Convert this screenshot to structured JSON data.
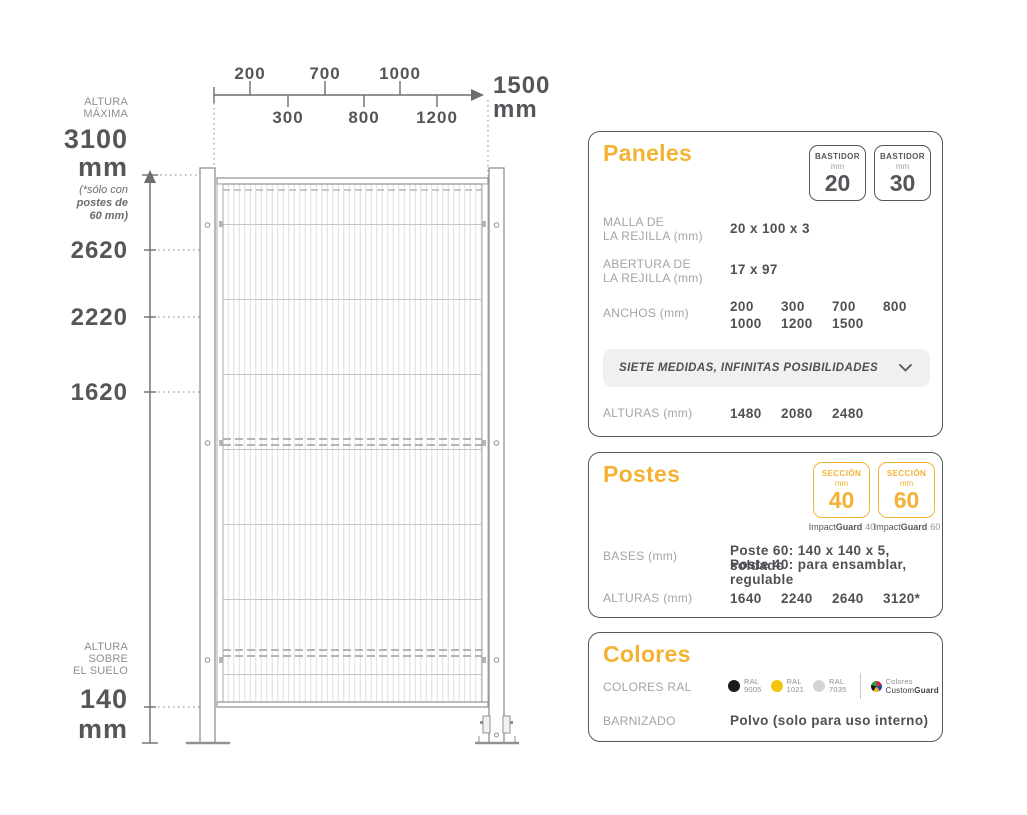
{
  "colors": {
    "accent": "#F4B233",
    "dark": "#54565A",
    "gray": "#A2A4A7"
  },
  "diagram": {
    "scale": {
      "above": [
        "200",
        "700",
        "1000"
      ],
      "below": [
        "300",
        "800",
        "1200"
      ],
      "total": "1500",
      "total_unit": "mm"
    },
    "altura_maxima": {
      "label_line1": "ALTURA",
      "label_line2": "MÁXIMA",
      "value": "3100",
      "unit": "mm",
      "note_line1": "(*sólo con",
      "note_line2": "postes de",
      "note_line3": "60 mm)"
    },
    "levels": [
      "2620",
      "2220",
      "1620"
    ],
    "altura_suelo": {
      "label_line1": "ALTURA",
      "label_line2": "SOBRE",
      "label_line3": "EL SUELO",
      "value": "140",
      "unit": "mm"
    }
  },
  "cards": {
    "paneles": {
      "title": "Paneles",
      "badges": [
        {
          "label": "BASTIDOR",
          "unit": "mm",
          "value": "20"
        },
        {
          "label": "BASTIDOR",
          "unit": "mm",
          "value": "30"
        }
      ],
      "malla": {
        "label_line1": "MALLA DE",
        "label_line2": "LA REJILLA (mm)",
        "value": "20 x 100 x 3"
      },
      "abertura": {
        "label_line1": "ABERTURA DE",
        "label_line2": "LA REJILLA (mm)",
        "value": "17 x 97"
      },
      "anchos": {
        "label": "ANCHOS (mm)",
        "row1": [
          "200",
          "300",
          "700",
          "800"
        ],
        "row2": [
          "1000",
          "1200",
          "1500"
        ]
      },
      "banner": {
        "text": "SIETE MEDIDAS, INFINITAS POSIBILIDADES"
      },
      "alturas": {
        "label": "ALTURAS (mm)",
        "values": [
          "1480",
          "2080",
          "2480"
        ]
      }
    },
    "postes": {
      "title": "Postes",
      "badges": [
        {
          "label": "SECCIÓN",
          "unit": "mm",
          "value": "40",
          "caption_brand": "Impact",
          "caption_bold": "Guard",
          "caption_num": "40"
        },
        {
          "label": "SECCIÓN",
          "unit": "mm",
          "value": "60",
          "caption_brand": "Impact",
          "caption_bold": "Guard",
          "caption_num": "60"
        }
      ],
      "bases": {
        "label": "BASES (mm)",
        "line1": "Poste 60: 140 x 140 x 5, soldado",
        "line2": "Poste 40: para ensamblar, regulable"
      },
      "alturas": {
        "label": "ALTURAS (mm)",
        "values": [
          "1640",
          "2240",
          "2640",
          "3120*"
        ]
      }
    },
    "colores": {
      "title": "Colores",
      "ral": {
        "label": "COLORES RAL",
        "swatches": [
          {
            "name": "RAL",
            "code": "9005",
            "hex": "#1A1A1A"
          },
          {
            "name": "RAL",
            "code": "1021",
            "hex": "#F2C50E"
          },
          {
            "name": "RAL",
            "code": "7035",
            "hex": "#D4D6D2"
          }
        ],
        "custom": {
          "line1": "Colores",
          "brand": "Custom",
          "brand_bold": "Guard"
        }
      },
      "barnizado": {
        "label": "BARNIZADO",
        "value": "Polvo (solo para uso interno)"
      }
    }
  }
}
